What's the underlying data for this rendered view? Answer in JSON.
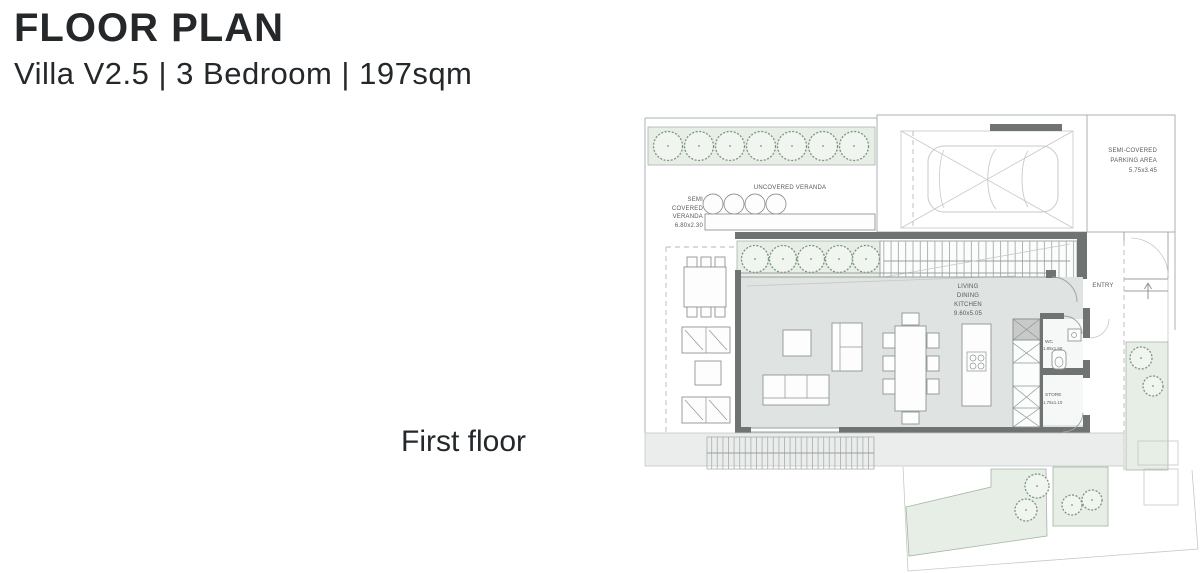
{
  "header": {
    "title": "FLOOR PLAN",
    "subtitle": "Villa V2.5 | 3 Bedroom | 197sqm"
  },
  "floor_label": "First floor",
  "plan": {
    "uncovered_veranda": "UNCOVERED VERANDA",
    "semi_veranda_l1": "SEMI",
    "semi_veranda_l2": "COVERED",
    "semi_veranda_l3": "VERANDA",
    "semi_veranda_l4": "6.80x2.30",
    "parking_l1": "SEMI-COVERED",
    "parking_l2": "PARKING AREA",
    "parking_l3": "5.75x3.45",
    "living_l1": "LIVING",
    "living_l2": "DINING",
    "living_l3": "KITCHEN",
    "living_l4": "9.60x5.05",
    "wc_l1": "WC",
    "wc_l2": "1.85x1.50",
    "store_l1": "STORE",
    "store_l2": "1.75x1.10",
    "entry": "ENTRY"
  },
  "theme": {
    "page_bg": "#ffffff",
    "title_color": "#24282a",
    "plan_text": "#565b5a",
    "wall": "#6f7473",
    "floor": "#dfe3e2",
    "green_band": "#e6eee6",
    "band_bg": "#eaedec",
    "tree_stroke": "#7b957e",
    "line": "#aab1b0",
    "line_light": "#c4c9c8"
  }
}
